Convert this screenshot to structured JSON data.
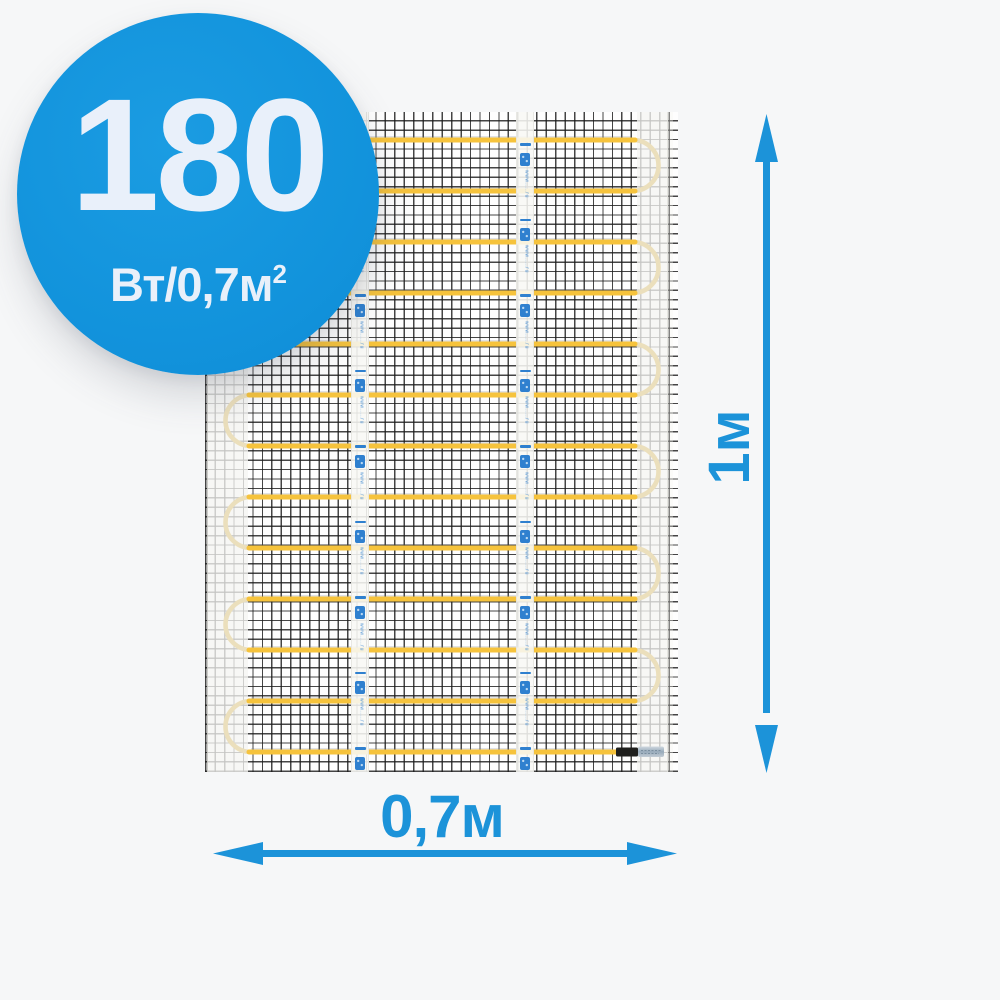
{
  "page": {
    "background_color": "#f6f7f8"
  },
  "badge": {
    "power_value": "180",
    "power_unit_prefix": "Вт/0,7м",
    "power_unit_superscript": "2",
    "background_color": "#1293dc",
    "text_color": "#e9f0fa"
  },
  "dimensions": {
    "height_label": "1м",
    "width_label": "0,7м",
    "arrow_color": "#1c93d9"
  },
  "mat": {
    "mat_background": "#fefefe",
    "mesh_color": "#1c1c1c",
    "cable_color": "#f6c33c",
    "cable_turn_color": "#ebdfbc",
    "cable_run_count": 13,
    "tape_count": 2,
    "tape_marks_per_tape": 9,
    "tape_url_text": "www.....ru",
    "tape_mark_color": "#2f80cf",
    "connector_sleeve_color": "#1f1f1d",
    "connector_crimp_colors": [
      "#cfd8df",
      "#97aaba",
      "#c2ccd4"
    ]
  }
}
